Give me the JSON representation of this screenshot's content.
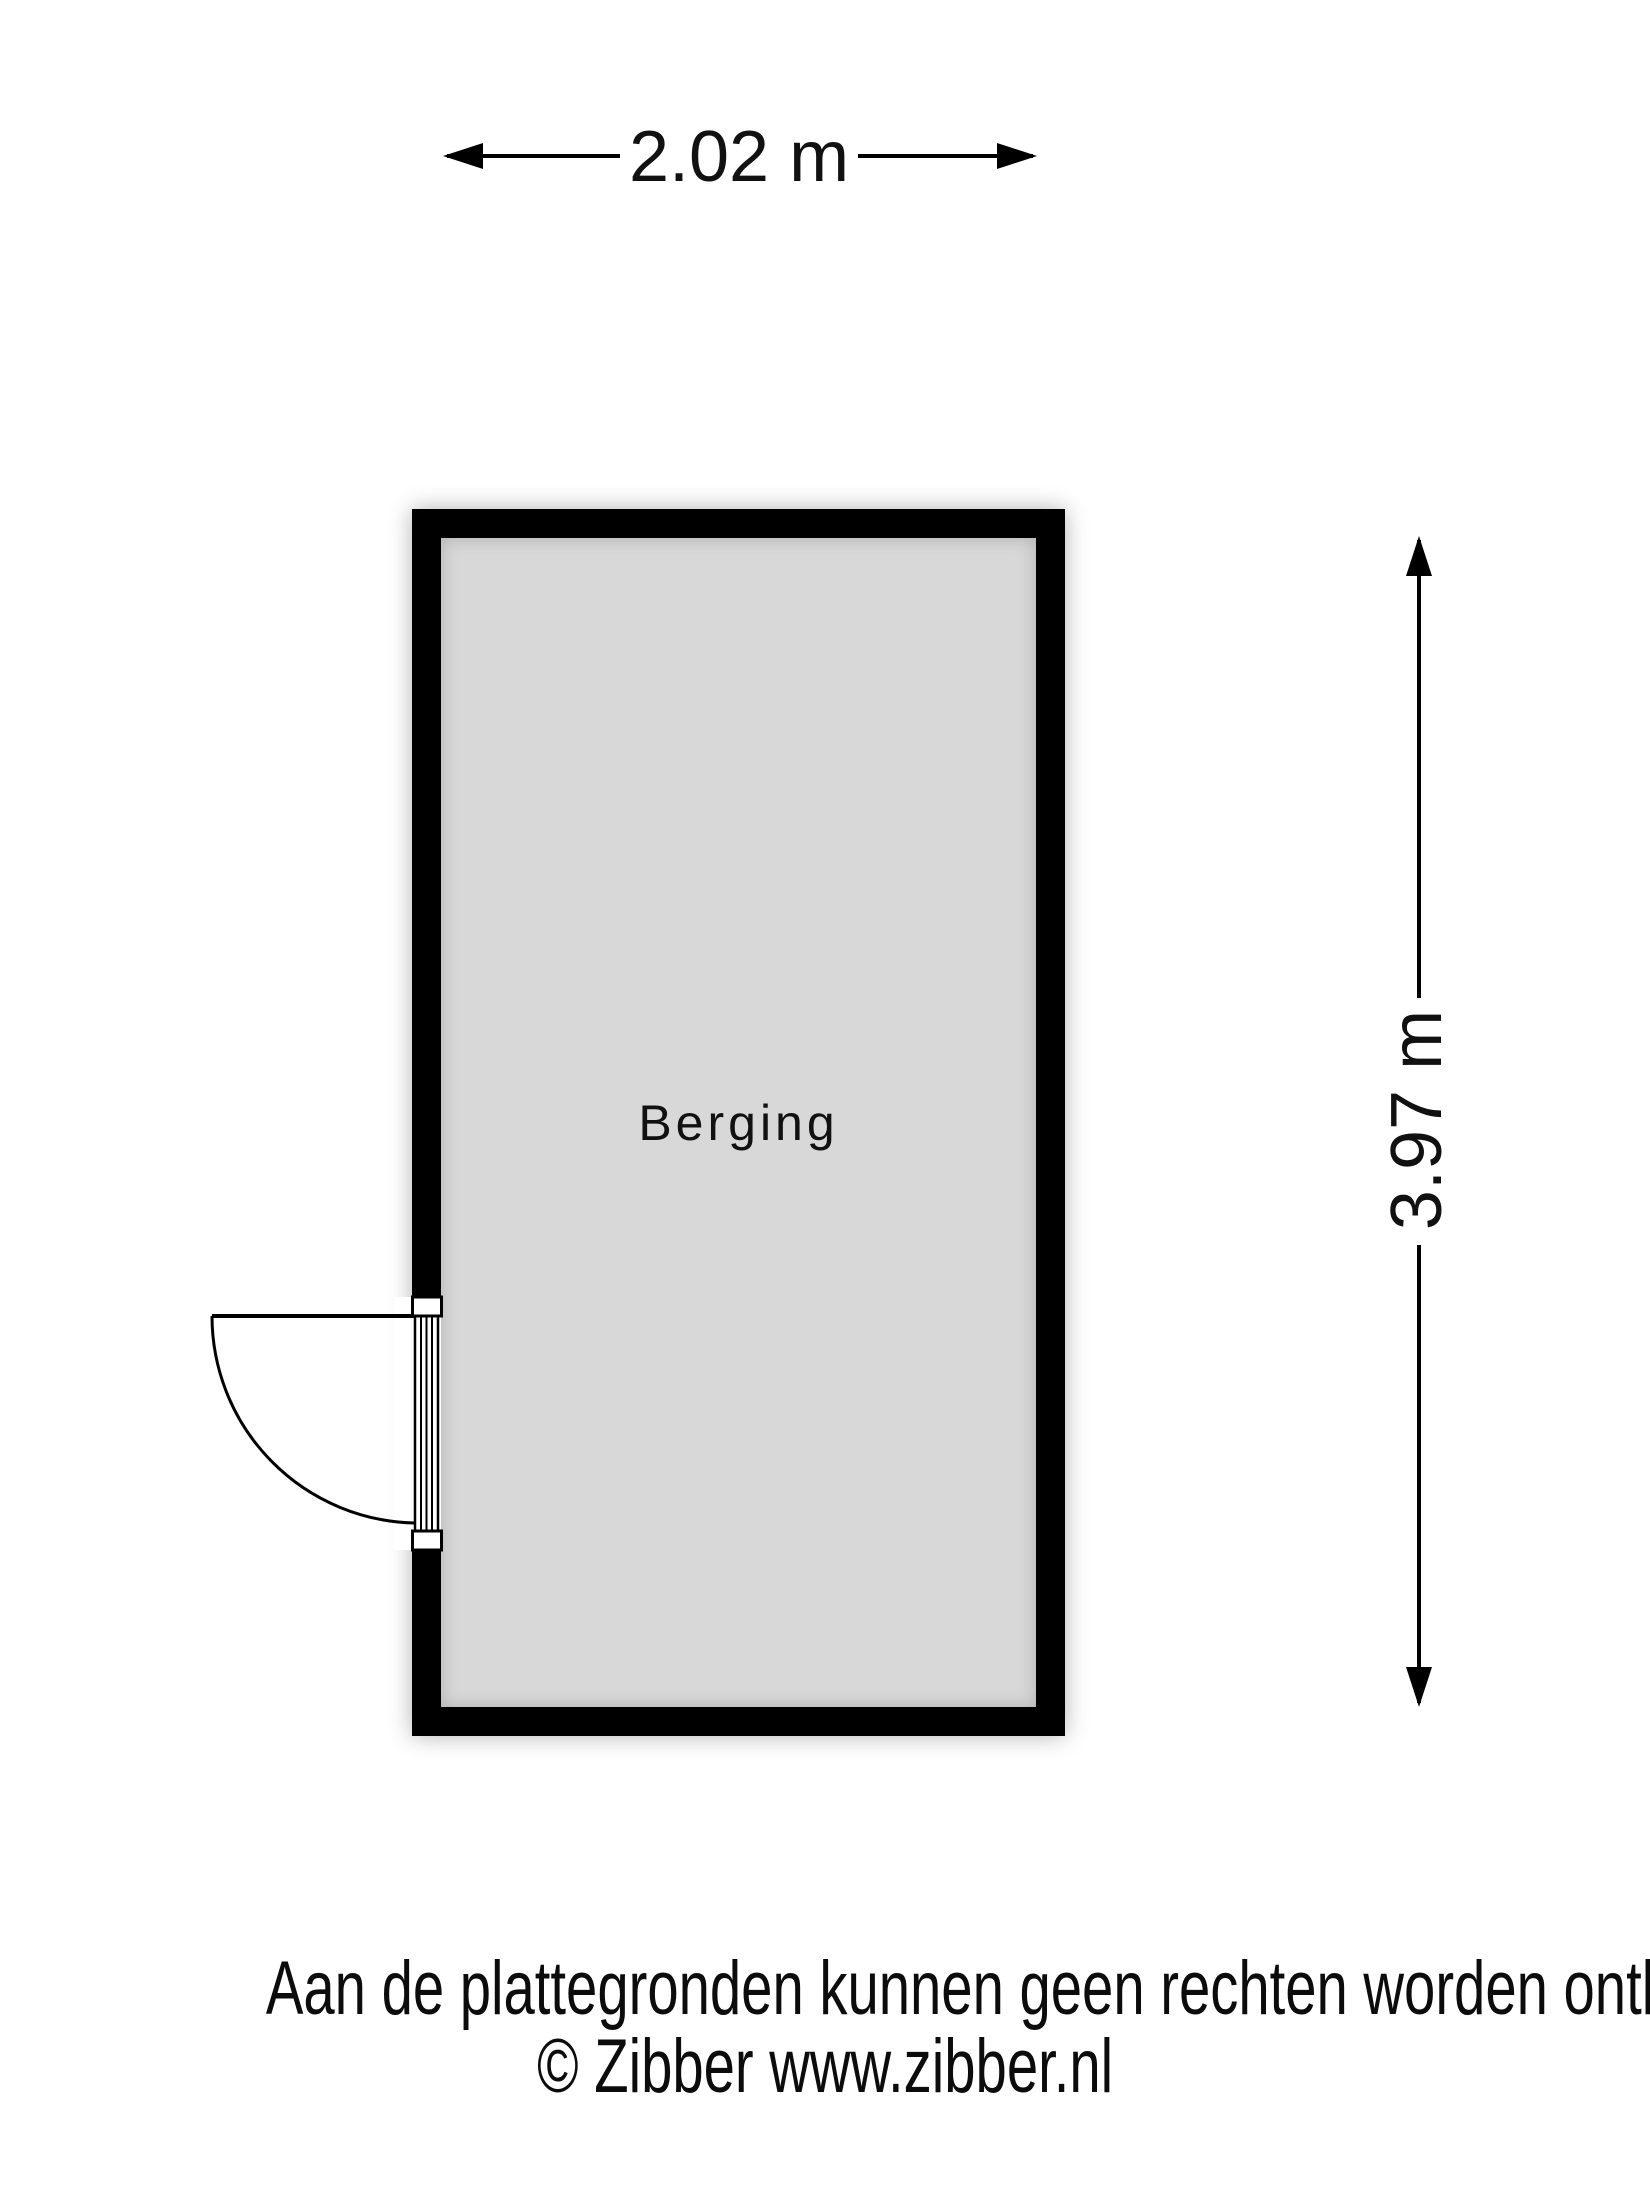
{
  "floorplan": {
    "room_label": "Berging",
    "width_dimension": "2.02 m",
    "height_dimension": "3.97 m",
    "colors": {
      "wall": "#000000",
      "floor": "#d8d8d8",
      "linework": "#000000",
      "text": "#111111",
      "background": "#ffffff"
    }
  },
  "footer": {
    "disclaimer": "Aan de plattegronden kunnen geen rechten worden ontleend",
    "copyright": "© Zibber www.zibber.nl"
  }
}
